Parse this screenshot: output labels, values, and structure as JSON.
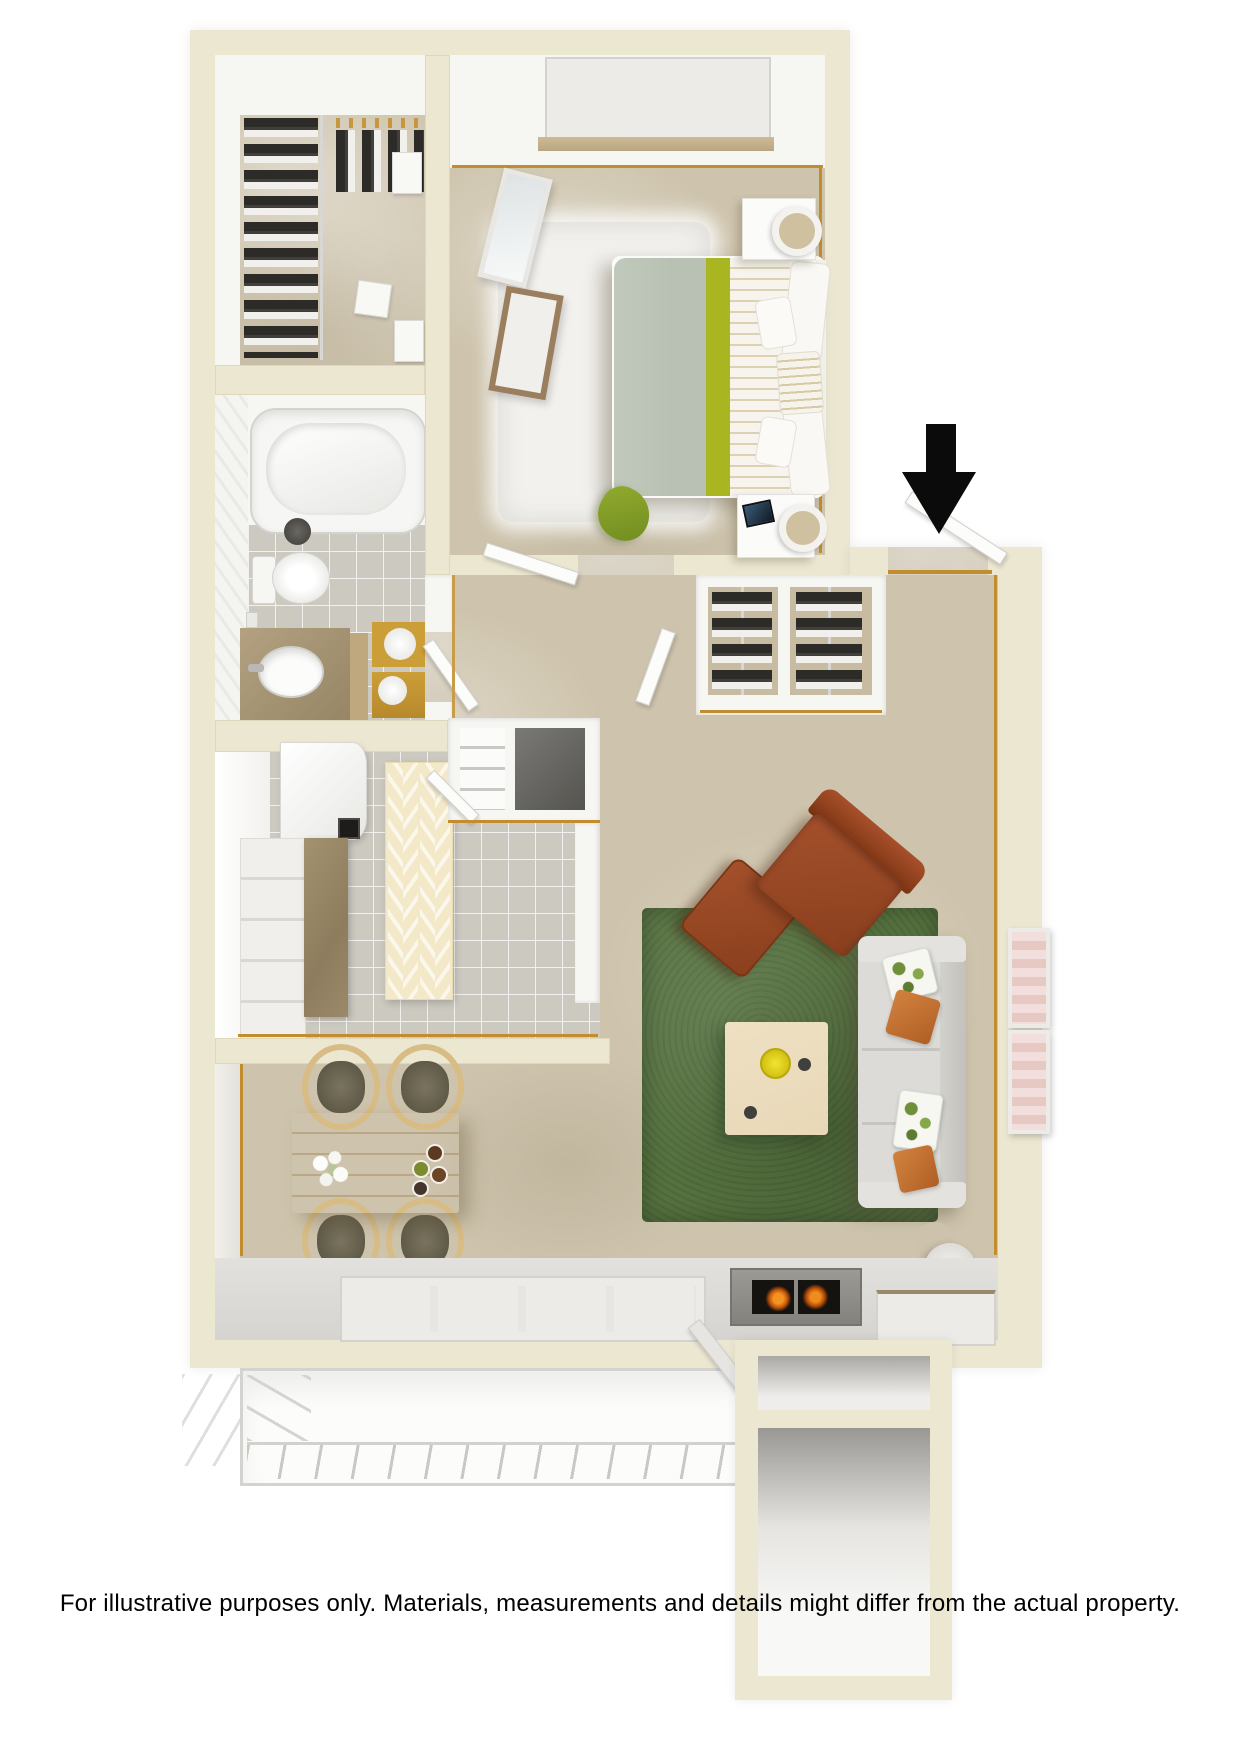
{
  "footer": {
    "disclaimer": "For illustrative purposes only.  Materials, measurements and details might differ from the actual property."
  },
  "icons": {
    "entry_arrow": "down-arrow"
  },
  "palette": {
    "background": "#ffffff",
    "wall_cream": "#ece7d1",
    "wall_white": "#f6f6f3",
    "carpet": "#cec4ad",
    "carpet_dark": "#c7bca2",
    "tile_gray": "#ccc9c0",
    "tile_light": "#dcd9d1",
    "rug_white": "#f2f1ee",
    "rug_green": "#55713f",
    "bed_sage": "#b8c1b3",
    "accent_olive": "#a9b621",
    "leather_brown": "#9d4a27",
    "pillow_orange": "#d2823f",
    "sofa_gray": "#dcdbd7",
    "wood_light": "#e5c98d",
    "wood_pale": "#e8d8b8",
    "chair_wood": "#d8bc86",
    "counter_tan": "#9a8a6a",
    "gold_mat": "#cc9e38",
    "gold_trim": "#c28d2f",
    "hanger_tan": "#c6973f",
    "glass": "#dde4e9",
    "dark_floor": "#6c6b68",
    "flame_orange": "#e06b12",
    "door_white": "#fcfcfa",
    "door_edge": "#cfcec9",
    "railing": "#c9c8c4",
    "arrow": "#0b0b0b",
    "text": "#000000"
  }
}
